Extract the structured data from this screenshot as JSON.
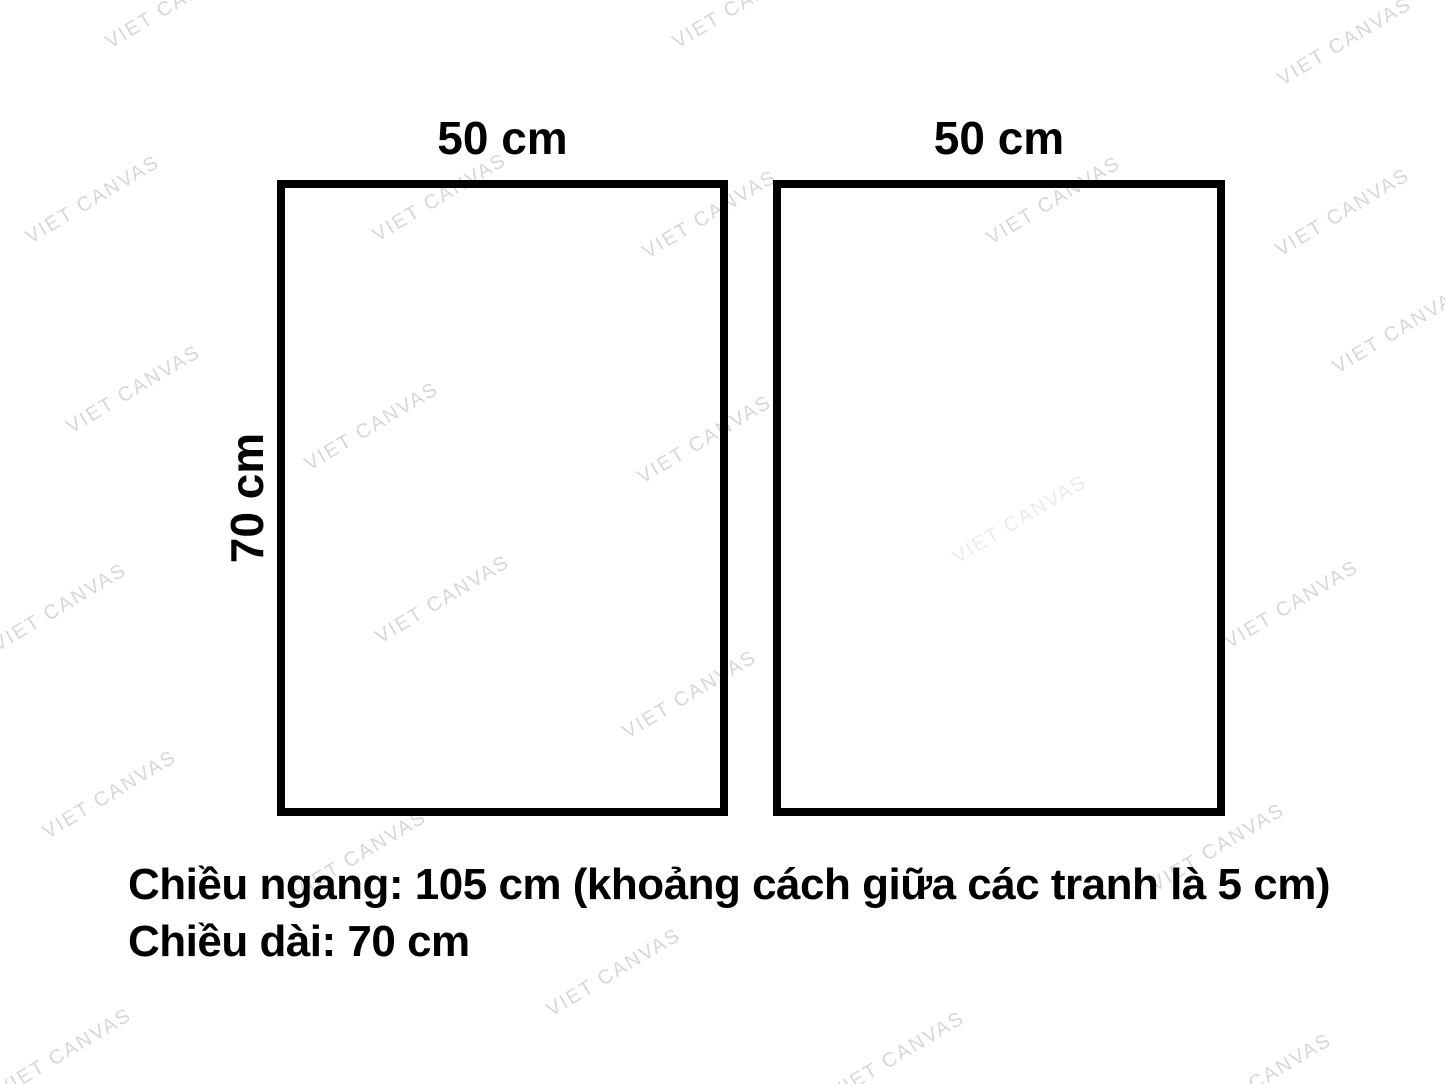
{
  "panels": [
    {
      "width_label": "50 cm"
    },
    {
      "width_label": "50 cm"
    }
  ],
  "height_label": "70 cm",
  "caption": {
    "line1": "Chiều ngang: 105 cm (khoảng cách giữa các tranh là 5 cm)",
    "line2": "Chiều dài: 70 cm"
  },
  "watermark": {
    "text": "VIET CANVAS",
    "angle_deg": -31,
    "color": "rgba(0,0,0,0.16)",
    "faint_color": "rgba(0,0,0,0.08)",
    "positions": [
      {
        "x": 173,
        "y": 5
      },
      {
        "x": 740,
        "y": 5
      },
      {
        "x": 1345,
        "y": 42
      },
      {
        "x": 93,
        "y": 200
      },
      {
        "x": 440,
        "y": 198
      },
      {
        "x": 710,
        "y": 215
      },
      {
        "x": 1054,
        "y": 201
      },
      {
        "x": 1343,
        "y": 213
      },
      {
        "x": 1400,
        "y": 330
      },
      {
        "x": 134,
        "y": 390
      },
      {
        "x": 372,
        "y": 427
      },
      {
        "x": 705,
        "y": 440
      },
      {
        "x": 1020,
        "y": 520,
        "faint": true
      },
      {
        "x": 60,
        "y": 608
      },
      {
        "x": 443,
        "y": 600
      },
      {
        "x": 1292,
        "y": 605
      },
      {
        "x": 690,
        "y": 695
      },
      {
        "x": 110,
        "y": 795
      },
      {
        "x": 360,
        "y": 855
      },
      {
        "x": 1218,
        "y": 848
      },
      {
        "x": 614,
        "y": 973
      },
      {
        "x": 898,
        "y": 1056
      },
      {
        "x": 65,
        "y": 1053
      },
      {
        "x": 1265,
        "y": 1078
      }
    ]
  }
}
